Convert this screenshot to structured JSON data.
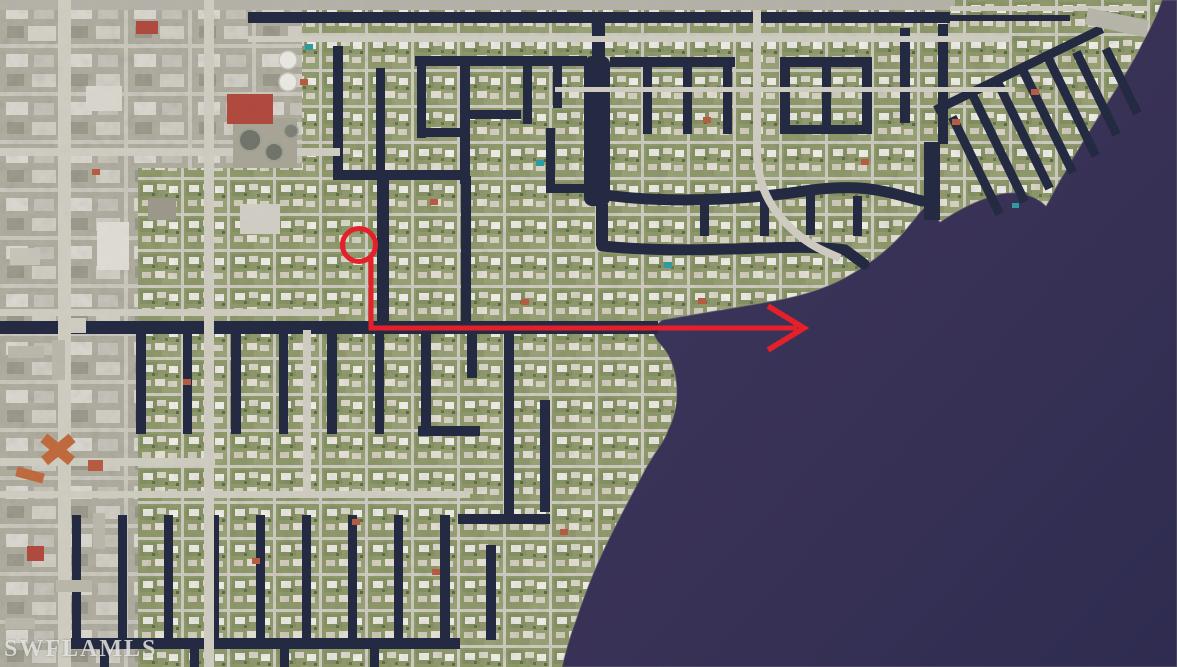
{
  "window": {
    "width": 1177,
    "height": 667
  },
  "map": {
    "type": "satellite-aerial-photo",
    "subject": "waterfront canal-front residential community beside a wide river",
    "watermark": "SWFLAMLS"
  },
  "annotation": {
    "color": "#e7202b",
    "stroke_width": 5,
    "marker_shape": "circle-with-arrow-to-river",
    "circle_path": "M 342.5 245 a 16.5 16.5 0 1 0 33 0 a 16.5 16.5 0 1 0 -33 0",
    "arrow_points": "371,258 371,328 797,328",
    "arrowhead_points": "768,306 804,328 768,350"
  },
  "colors": {
    "water": "#3a3760",
    "water_mid": "#393257",
    "water_deep": "#2e2c50",
    "canal": "#242a42",
    "land": "#8d9868",
    "road": "#cfccc1",
    "highway": "#b5b2a8",
    "commercial_land": "#b0ad9f",
    "red_roof": "#b14a3e",
    "orange_roof": "#c06a3e",
    "annotation_red": "#e7202b",
    "watermark_text": "rgba(235,235,232,0.82)",
    "shoreline_edge": "#8d8b7c"
  }
}
